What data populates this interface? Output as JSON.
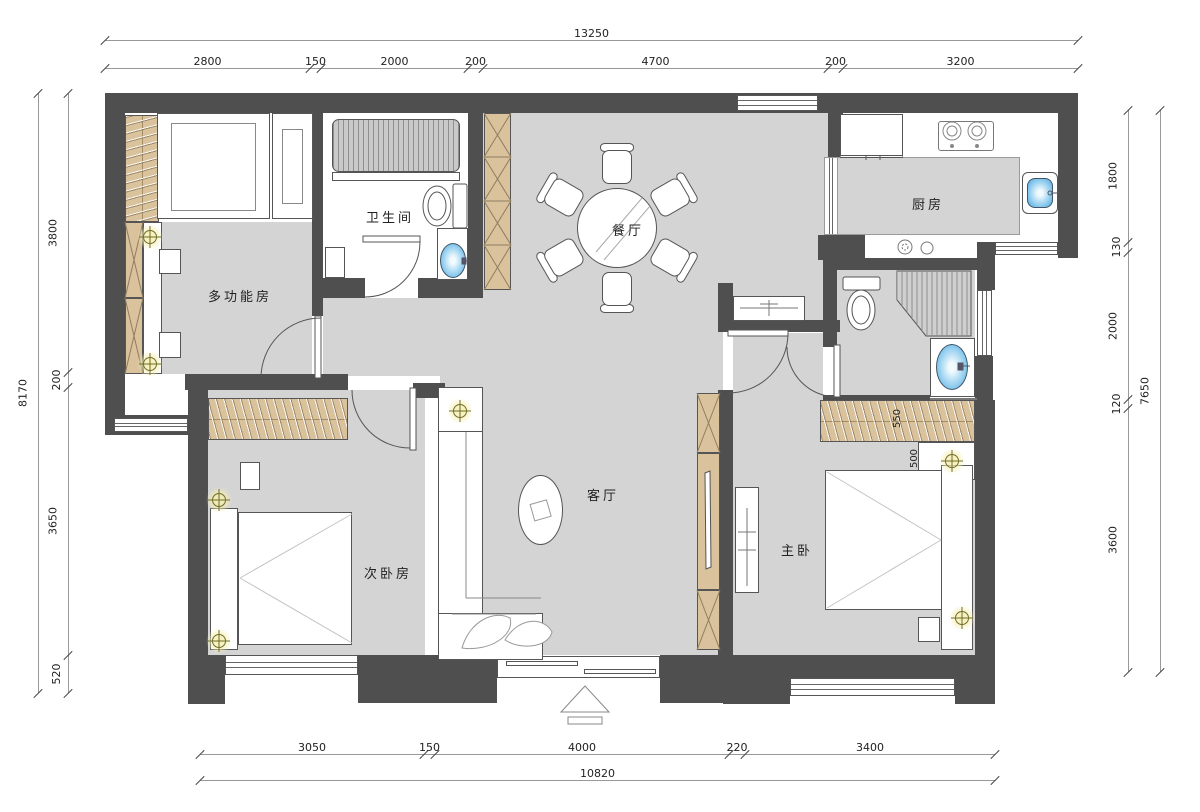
{
  "rooms": {
    "multi_function": "多功能房",
    "bathroom": "卫生间",
    "dining": "餐厅",
    "kitchen": "厨房",
    "second_bedroom": "次卧房",
    "living": "客厅",
    "master_bedroom": "主卧"
  },
  "dimensions": {
    "top": {
      "total": "13250",
      "segments": [
        "2800",
        "150",
        "2000",
        "200",
        "4700",
        "200",
        "3200"
      ]
    },
    "bottom": {
      "total": "10820",
      "segments": [
        "3050",
        "150",
        "4000",
        "220",
        "3400"
      ]
    },
    "left": {
      "total": "8170",
      "segments": [
        "3800",
        "200",
        "3650",
        "520"
      ]
    },
    "right": {
      "total": "7650",
      "segments": [
        "1800",
        "130",
        "2000",
        "120",
        "3600"
      ]
    },
    "inner": {
      "wardrobe_depth": "550",
      "bedside_ledge": "500"
    }
  },
  "colors": {
    "wall": "#4f4f4f",
    "floor": "#d4d4d4",
    "wood": "#d9c29c",
    "water_blue": "#8fccee",
    "lamp_glow": "#f6eeb2"
  }
}
